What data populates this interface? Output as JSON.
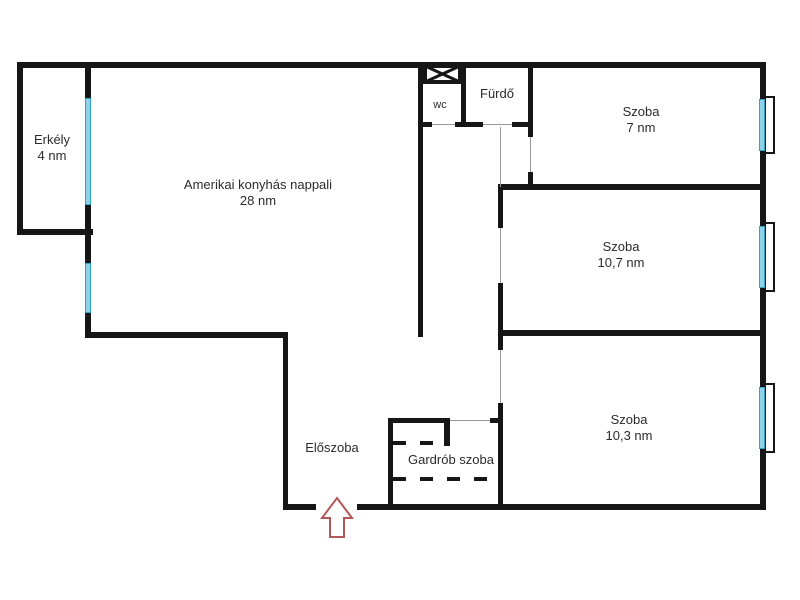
{
  "plan": {
    "title": "apartment-floor-plan",
    "rooms": {
      "balcony": {
        "name": "Erkély",
        "area": "4 nm"
      },
      "living": {
        "name": "Amerikai konyhás nappali",
        "area": "28 nm"
      },
      "wc": {
        "name": "wc",
        "area": ""
      },
      "bathroom": {
        "name": "Fürdő",
        "area": ""
      },
      "room_small": {
        "name": "Szoba",
        "area": "7 nm"
      },
      "room_mid": {
        "name": "Szoba",
        "area": "10,7 nm"
      },
      "room_large": {
        "name": "Szoba",
        "area": "10,3 nm"
      },
      "hallway": {
        "name": "Előszoba",
        "area": ""
      },
      "wardrobe": {
        "name": "Gardrób szoba",
        "area": ""
      }
    },
    "icons": {
      "entrance_arrow": "up-arrow-entrance-marker",
      "shaft": "x-crossed-box-shaft",
      "windows": "cyan-window-lines",
      "wardrobe_dashes": "dashed-closet-lines"
    },
    "colors": {
      "wall": "#161616",
      "window": "#8ed2e8",
      "window_edge": "#2fa3c6",
      "door_line": "#9a9a9a",
      "entrance_arrow": "#b25858",
      "text": "#2b2b2b"
    }
  }
}
